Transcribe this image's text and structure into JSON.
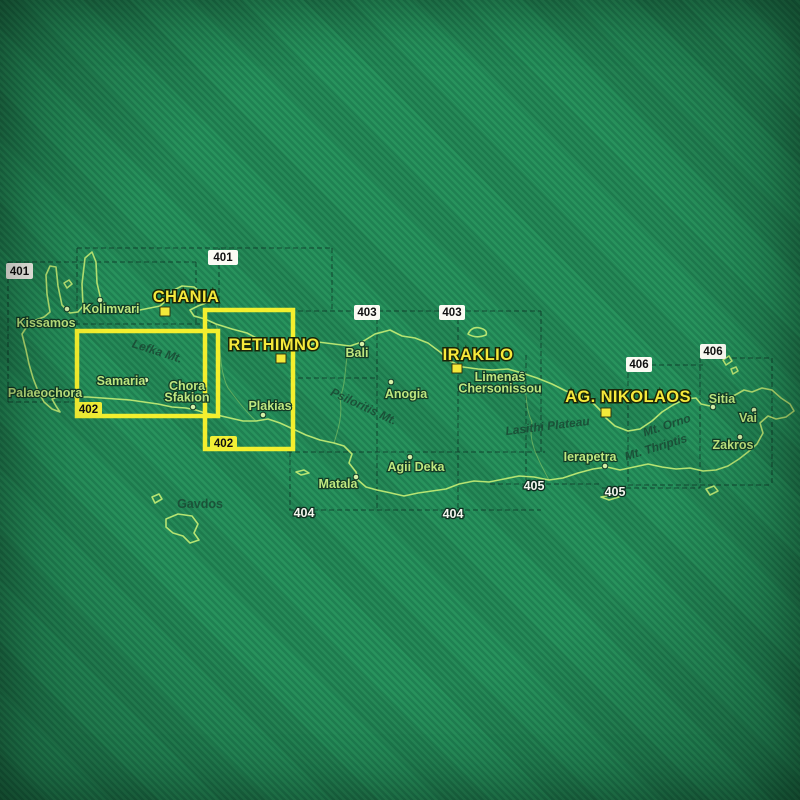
{
  "map": {
    "description": "Index map of Crete showing road-map sheet coverage 401-406, sheet 402 highlighted in yellow",
    "colors": {
      "background_stripe_dark": "#1f8152",
      "background_stripe_light": "#28935d",
      "coastline": "#b6e472",
      "highlight_yellow": "#f3ef2e",
      "city_label": "#f6e93b",
      "town_label": "#bfe77f",
      "feature_label": "#1a4a34",
      "sheet_box_white": "#fbfbf3",
      "sheet_box_yellow": "#f2ef35",
      "grid_line": "#0f3526"
    },
    "coastline_path": "M 22 334 L 30 322 L 44 317 L 50 312 L 47 294 L 46 275 L 50 266 L 56 267 L 58 286 L 62 305 L 70 313 L 78 312 L 83 306 L 82 284 L 85 258 L 92 252 L 96 262 L 97 283 L 101 300 L 108 308 L 120 310 L 135 311 L 150 308 L 160 306 L 167 300 L 172 291 L 182 286 L 194 287 L 203 294 L 206 303 L 198 306 L 190 310 L 194 316 L 205 319 L 216 324 L 232 329 L 247 333 L 262 341 L 274 350 L 288 351 L 302 348 L 318 342 L 334 344 L 350 346 L 362 342 L 375 334 L 390 330 L 402 336 L 415 338 L 428 343 L 440 352 L 450 361 L 463 367 L 478 369 L 492 370 L 508 369 L 522 373 L 537 378 L 552 384 L 566 391 L 580 396 L 592 402 L 600 410 L 606 418 L 615 426 L 628 431 L 640 429 L 652 421 L 662 412 L 673 405 L 685 399 L 696 398 L 701 404 L 710 406 L 719 401 L 729 398 L 737 394 L 744 390 L 752 392 L 762 388 L 772 390 L 781 398 L 790 404 L 794 411 L 786 417 L 776 419 L 768 416 L 760 423 L 763 433 L 757 444 L 748 452 L 739 459 L 728 466 L 716 470 L 703 471 L 690 468 L 676 469 L 662 467 L 648 464 L 634 467 L 620 470 L 607 467 L 593 469 L 578 473 L 563 478 L 549 480 L 534 477 L 519 476 L 504 479 L 489 482 L 474 481 L 459 484 L 446 489 L 432 491 L 418 493 L 404 496 L 391 493 L 377 490 L 366 487 L 358 480 L 356 472 L 349 463 L 352 454 L 344 446 L 334 443 L 320 440 L 306 435 L 293 429 L 280 423 L 268 419 L 256 421 L 243 421 L 230 418 L 217 415 L 205 413 L 196 410 L 186 408 L 172 407 L 158 404 L 144 402 L 130 400 L 116 399 L 102 398 L 88 397 L 74 397 L 62 396 L 52 399 L 56 406 L 60 412 L 52 409 L 44 402 L 38 391 L 33 378 L 29 364 L 26 350 Z",
    "islands": [
      {
        "name": "gramvousa-islet",
        "path": "M 64 283 L 69 280 L 72 284 L 67 288 Z"
      },
      {
        "name": "dia",
        "path": "M 468 334 Q 472 326 480 328 Q 488 330 486 335 Q 476 339 468 334 Z"
      },
      {
        "name": "dionysades-1",
        "path": "M 723 360 L 729 356 L 732 361 L 726 365 Z"
      },
      {
        "name": "dionysades-2",
        "path": "M 731 369 L 736 367 L 738 371 L 733 374 Z"
      },
      {
        "name": "gavdos",
        "path": "M 166 519 L 178 514 L 192 516 L 198 524 L 194 533 L 199 540 L 190 543 L 183 536 L 173 533 L 166 527 Z"
      },
      {
        "name": "gavdopoula",
        "path": "M 152 497 L 159 494 L 162 499 L 155 503 Z"
      },
      {
        "name": "paximadia",
        "path": "M 296 472 L 304 470 L 309 473 L 301 475 Z"
      },
      {
        "name": "chrissi",
        "path": "M 601 497 L 611 495 L 619 497 L 609 500 Z"
      },
      {
        "name": "koufonisi",
        "path": "M 706 489 L 714 486 L 718 491 L 710 495 Z"
      }
    ],
    "boundaries": [
      "M 216 324 C 222 345 218 368 228 388 C 240 404 248 414 256 421",
      "M 350 346 C 344 362 347 380 340 398 C 343 415 338 430 334 443",
      "M 522 373 C 528 390 524 406 532 422 C 528 440 536 456 549 480"
    ],
    "grid_segments": [
      [
        77,
        248,
        332,
        248
      ],
      [
        8,
        262,
        196,
        262
      ],
      [
        75,
        324,
        215,
        324
      ],
      [
        8,
        402,
        77,
        402
      ],
      [
        290,
        311,
        541,
        311
      ],
      [
        287,
        452,
        545,
        452
      ],
      [
        290,
        378,
        378,
        378
      ],
      [
        289,
        510,
        541,
        510
      ],
      [
        490,
        484,
        602,
        484
      ],
      [
        602,
        488,
        700,
        488
      ],
      [
        627,
        365,
        703,
        365
      ],
      [
        700,
        358,
        772,
        358
      ],
      [
        628,
        485,
        772,
        485
      ],
      [
        8,
        262,
        8,
        402
      ],
      [
        77,
        248,
        77,
        331
      ],
      [
        196,
        262,
        196,
        324
      ],
      [
        219,
        248,
        219,
        310
      ],
      [
        332,
        248,
        332,
        311
      ],
      [
        377,
        311,
        377,
        510
      ],
      [
        458,
        311,
        458,
        510
      ],
      [
        526,
        355,
        526,
        484
      ],
      [
        541,
        311,
        541,
        452
      ],
      [
        628,
        365,
        628,
        485
      ],
      [
        700,
        358,
        700,
        488
      ],
      [
        772,
        358,
        772,
        485
      ],
      [
        290,
        452,
        290,
        510
      ]
    ],
    "highlight_rects": [
      {
        "x": 77,
        "y": 331,
        "w": 141,
        "h": 85
      },
      {
        "x": 205,
        "y": 310,
        "w": 88,
        "h": 139
      }
    ],
    "sheet_labels": [
      {
        "number": "401",
        "style": "white-box",
        "x": 6,
        "y": 263,
        "w": 27,
        "h": 16
      },
      {
        "number": "401",
        "style": "white-box",
        "x": 208,
        "y": 250,
        "w": 30,
        "h": 15
      },
      {
        "number": "402",
        "style": "yellow-box",
        "x": 75,
        "y": 402,
        "w": 27,
        "h": 15
      },
      {
        "number": "402",
        "style": "yellow-box",
        "x": 210,
        "y": 436,
        "w": 27,
        "h": 15
      },
      {
        "number": "403",
        "style": "white-box",
        "x": 354,
        "y": 305,
        "w": 26,
        "h": 15
      },
      {
        "number": "403",
        "style": "white-box",
        "x": 439,
        "y": 305,
        "w": 26,
        "h": 15
      },
      {
        "number": "404",
        "style": "plain-text",
        "x": 291,
        "y": 506,
        "w": 26,
        "h": 15
      },
      {
        "number": "404",
        "style": "plain-text",
        "x": 440,
        "y": 507,
        "w": 26,
        "h": 15
      },
      {
        "number": "405",
        "style": "plain-text",
        "x": 521,
        "y": 479,
        "w": 26,
        "h": 15
      },
      {
        "number": "405",
        "style": "plain-text",
        "x": 602,
        "y": 485,
        "w": 26,
        "h": 15
      },
      {
        "number": "406",
        "style": "white-box",
        "x": 626,
        "y": 357,
        "w": 26,
        "h": 15
      },
      {
        "number": "406",
        "style": "white-box",
        "x": 700,
        "y": 344,
        "w": 26,
        "h": 15
      }
    ],
    "cities": [
      {
        "name": "CHANIA",
        "x": 186,
        "y": 302,
        "marker": [
          160,
          307
        ]
      },
      {
        "name": "RETHIMNO",
        "x": 274,
        "y": 350,
        "marker": [
          276,
          354
        ]
      },
      {
        "name": "IRAKLIO",
        "x": 478,
        "y": 360,
        "marker": [
          452,
          364
        ]
      },
      {
        "name": "AG. NIKOLAOS",
        "x": 628,
        "y": 402,
        "marker": [
          601,
          408
        ]
      }
    ],
    "towns": [
      {
        "name": "Kissamos",
        "lines": [
          "Kissamos"
        ],
        "x": 46,
        "y": 327,
        "dot": [
          67,
          309
        ]
      },
      {
        "name": "Kolimvari",
        "lines": [
          "Kolimvari"
        ],
        "x": 111,
        "y": 313,
        "dot": [
          100,
          300
        ]
      },
      {
        "name": "Palaeochora",
        "lines": [
          "Palaeochora"
        ],
        "x": 45,
        "y": 397,
        "dot": null
      },
      {
        "name": "Samaria",
        "lines": [
          "Samaria"
        ],
        "x": 121,
        "y": 385,
        "dot": [
          146,
          380
        ]
      },
      {
        "name": "Chora Sfakion",
        "lines": [
          "Chora",
          "Sfakion"
        ],
        "x": 187,
        "y": 390,
        "dot": [
          193,
          407
        ]
      },
      {
        "name": "Plakias",
        "lines": [
          "Plakias"
        ],
        "x": 270,
        "y": 410,
        "dot": [
          263,
          415
        ]
      },
      {
        "name": "Bali",
        "lines": [
          "Bali"
        ],
        "x": 357,
        "y": 357,
        "dot": [
          362,
          344
        ]
      },
      {
        "name": "Anogia",
        "lines": [
          "Anogia"
        ],
        "x": 406,
        "y": 398,
        "dot": [
          391,
          382
        ]
      },
      {
        "name": "Limenas Chersonissou",
        "lines": [
          "Limenas",
          "Chersonissou"
        ],
        "x": 500,
        "y": 381,
        "dot": [
          522,
          374
        ]
      },
      {
        "name": "Matala",
        "lines": [
          "Matala"
        ],
        "x": 338,
        "y": 488,
        "dot": [
          356,
          477
        ]
      },
      {
        "name": "Agii Deka",
        "lines": [
          "Agii Deka"
        ],
        "x": 416,
        "y": 471,
        "dot": [
          410,
          457
        ]
      },
      {
        "name": "Ierapetra",
        "lines": [
          "Ierapetra"
        ],
        "x": 590,
        "y": 461,
        "dot": [
          605,
          466
        ]
      },
      {
        "name": "Sitia",
        "lines": [
          "Sitia"
        ],
        "x": 722,
        "y": 403,
        "dot": [
          713,
          407
        ]
      },
      {
        "name": "Vai",
        "lines": [
          "Vai"
        ],
        "x": 748,
        "y": 422,
        "dot": [
          754,
          410
        ]
      },
      {
        "name": "Zakros",
        "lines": [
          "Zakros"
        ],
        "x": 733,
        "y": 449,
        "dot": [
          740,
          437
        ]
      }
    ],
    "island_names": [
      {
        "name": "Gavdos",
        "x": 200,
        "y": 508
      }
    ],
    "features": [
      {
        "name": "Lefka Mt.",
        "x": 156,
        "y": 355,
        "angle": 18
      },
      {
        "name": "Psiloritis Mt.",
        "x": 362,
        "y": 410,
        "angle": 25
      },
      {
        "name": "Lasithi Plateau",
        "x": 548,
        "y": 430,
        "angle": -7
      },
      {
        "name": "Mt. Orno",
        "x": 668,
        "y": 429,
        "angle": -18
      },
      {
        "name": "Mt. Thriptis",
        "x": 657,
        "y": 451,
        "angle": -17
      }
    ]
  }
}
